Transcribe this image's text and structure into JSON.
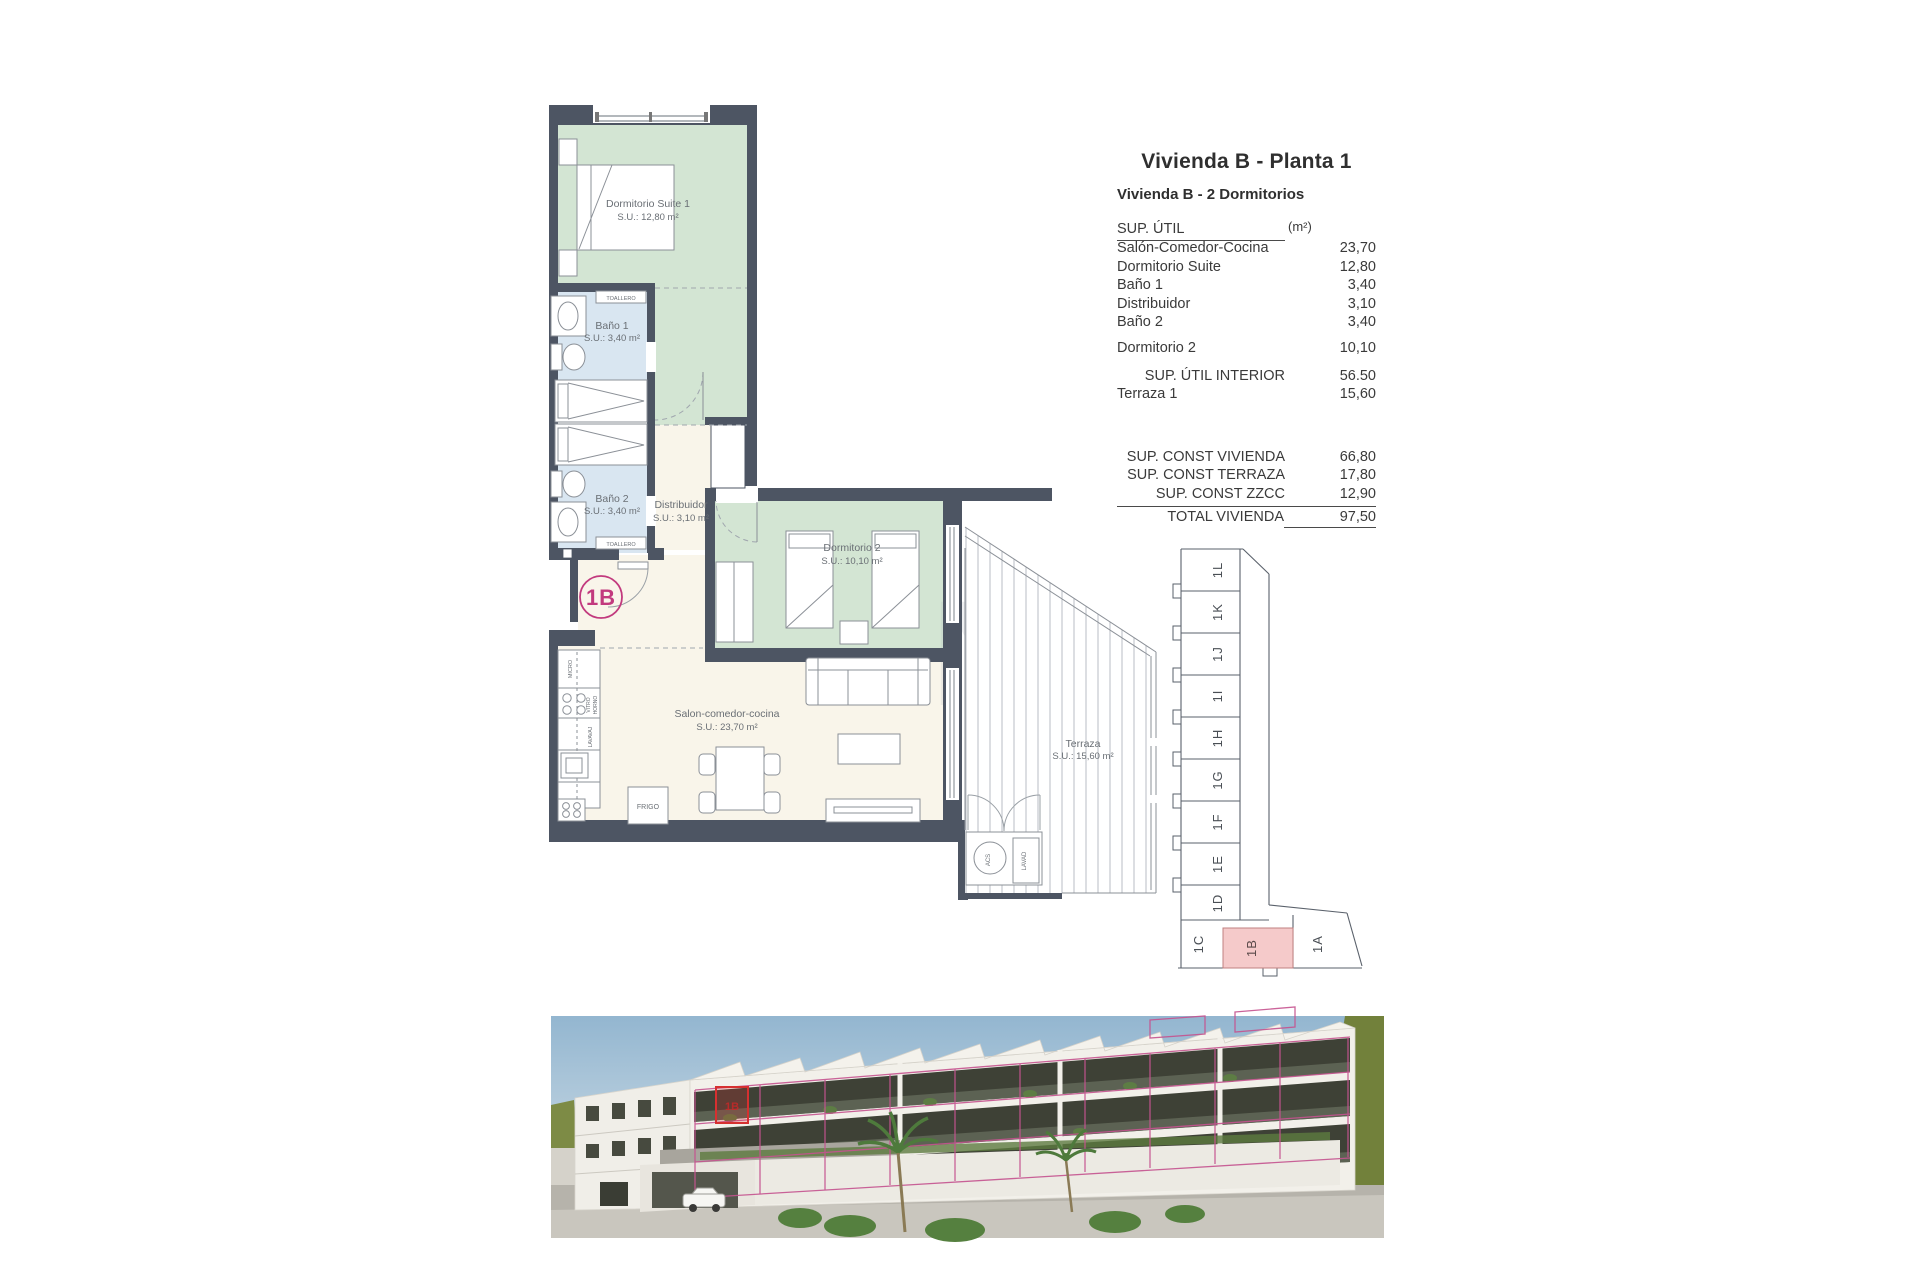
{
  "page": {
    "title": "Vivienda B - Planta 1",
    "subtitle": "Vivienda B - 2 Dormitorios"
  },
  "area_table": {
    "header": {
      "label": "SUP. ÚTIL",
      "unit": "(m²)"
    },
    "rows": [
      {
        "label": "Salón-Comedor-Cocina",
        "value": "23,70"
      },
      {
        "label": "Dormitorio Suite",
        "value": "12,80"
      },
      {
        "label": "Baño 1",
        "value": "3,40"
      },
      {
        "label": "Distribuidor",
        "value": "3,10"
      },
      {
        "label": "Baño 2",
        "value": "3,40"
      },
      {
        "label": "Dormitorio 2",
        "value": "10,10"
      }
    ],
    "interior_total": {
      "label": "SUP. ÚTIL INTERIOR",
      "value": "56.50"
    },
    "terraza": {
      "label": "Terraza 1",
      "value": "15,60"
    },
    "const_rows": [
      {
        "label": "SUP. CONST VIVIENDA",
        "value": "66,80"
      },
      {
        "label": "SUP. CONST TERRAZA",
        "value": "17,80"
      },
      {
        "label": "SUP. CONST ZZCC",
        "value": "12,90"
      }
    ],
    "total": {
      "label": "TOTAL VIVIENDA",
      "value": "97,50"
    }
  },
  "plan": {
    "unit_badge": "1B",
    "rooms": {
      "suite": {
        "name": "Dormitorio Suite 1",
        "area": "S.U.: 12,80 m²"
      },
      "bano1": {
        "name": "Baño 1",
        "area": "S.U.: 3,40 m²"
      },
      "bano2": {
        "name": "Baño 2",
        "area": "S.U.: 3,40 m²"
      },
      "distribuidor": {
        "name": "Distribuidor",
        "area": "S.U.: 3,10 m²"
      },
      "dorm2": {
        "name": "Dormitorio 2",
        "area": "S.U.: 10,10 m²"
      },
      "salon": {
        "name": "Salon-comedor-cocina",
        "area": "S.U.: 23,70 m²"
      },
      "terraza": {
        "name": "Terraza",
        "area": "S.U.: 15,60 m²"
      }
    },
    "fixtures": {
      "toallero": "TOALLERO",
      "micro": "MICRO",
      "vitro1": "VITRO",
      "vitro2": "HORNO",
      "lavavaj": "LAVAVAJ",
      "frigo": "FRIGO",
      "acs": "ACS",
      "lavad": "LAVAD"
    },
    "watermark": "N"
  },
  "key_diagram": {
    "units": [
      "1L",
      "1K",
      "1J",
      "1I",
      "1H",
      "1G",
      "1F",
      "1E",
      "1D",
      "1C"
    ],
    "highlight": "1B",
    "corner": "1A"
  },
  "render_badge": "1B",
  "colors": {
    "wall": "#4d5563",
    "bedroom_green": "#d3e5d3",
    "bath_blue": "#d9e6f1",
    "floor_cream": "#f9f5ea",
    "badge_magenta": "#c23a7e",
    "key_highlight_pink": "#f5caca",
    "overlay_pink": "#c5538f",
    "highlight_red": "#d63030"
  }
}
